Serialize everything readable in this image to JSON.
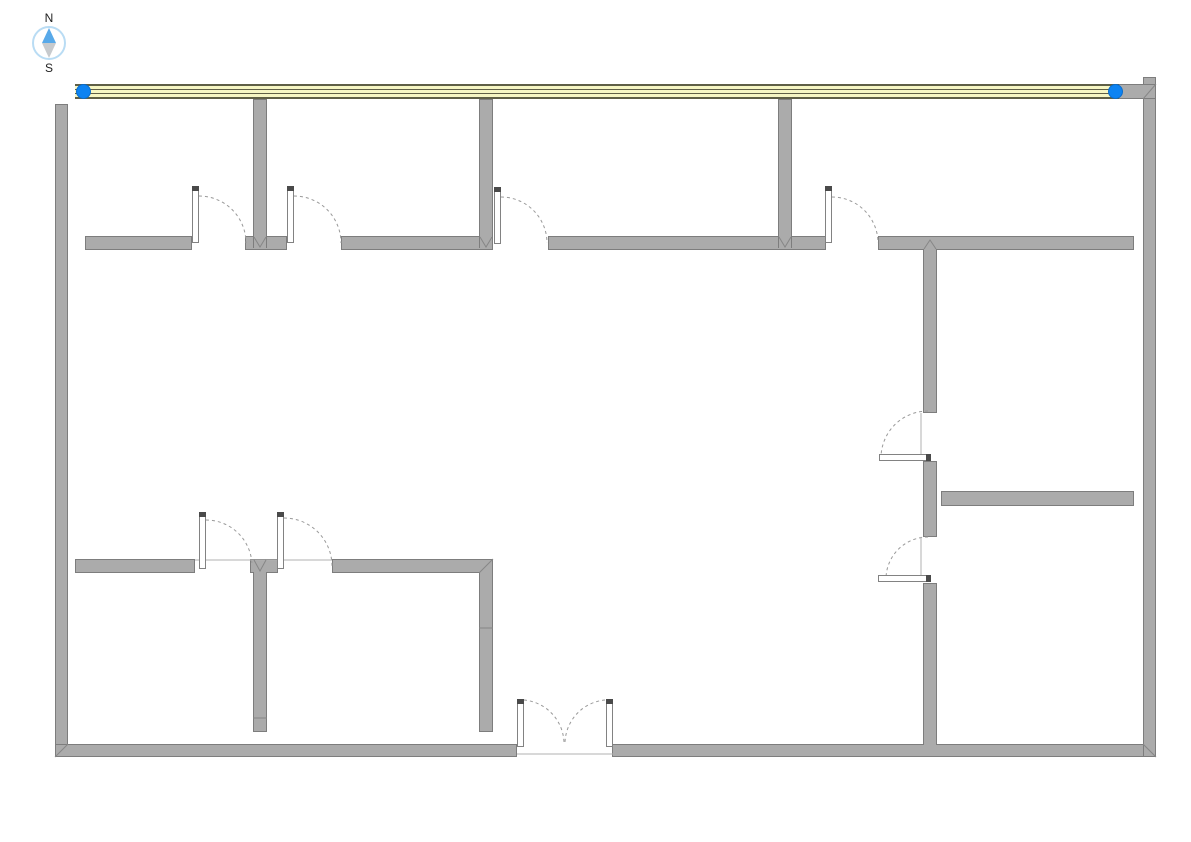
{
  "canvas": {
    "width_px": 1191,
    "height_px": 842,
    "background": "#ffffff"
  },
  "compass": {
    "north_label": "N",
    "south_label": "S"
  },
  "selection": {
    "selected_wall": "top-exterior-wall",
    "handle_positions": [
      "left-end",
      "right-end"
    ],
    "handle_shape": "circle"
  },
  "doors": {
    "single_door_count": 8,
    "double_door_count": 1
  },
  "theme": {
    "wall-fill": "#ababab",
    "wall-outline": "#7d7d7d",
    "selected-fill": "#f6f6c3",
    "stripe": "#5f5f46",
    "handle": "#0d83f2",
    "arc": "#999999",
    "panel-fill": "#ffffff",
    "panel-outline": "#828282",
    "ring": "#b9dcf4",
    "needle-n": "#58a9e9",
    "needle-s": "#c7cacd",
    "bg": "#ffffff",
    "text": "#222222"
  }
}
